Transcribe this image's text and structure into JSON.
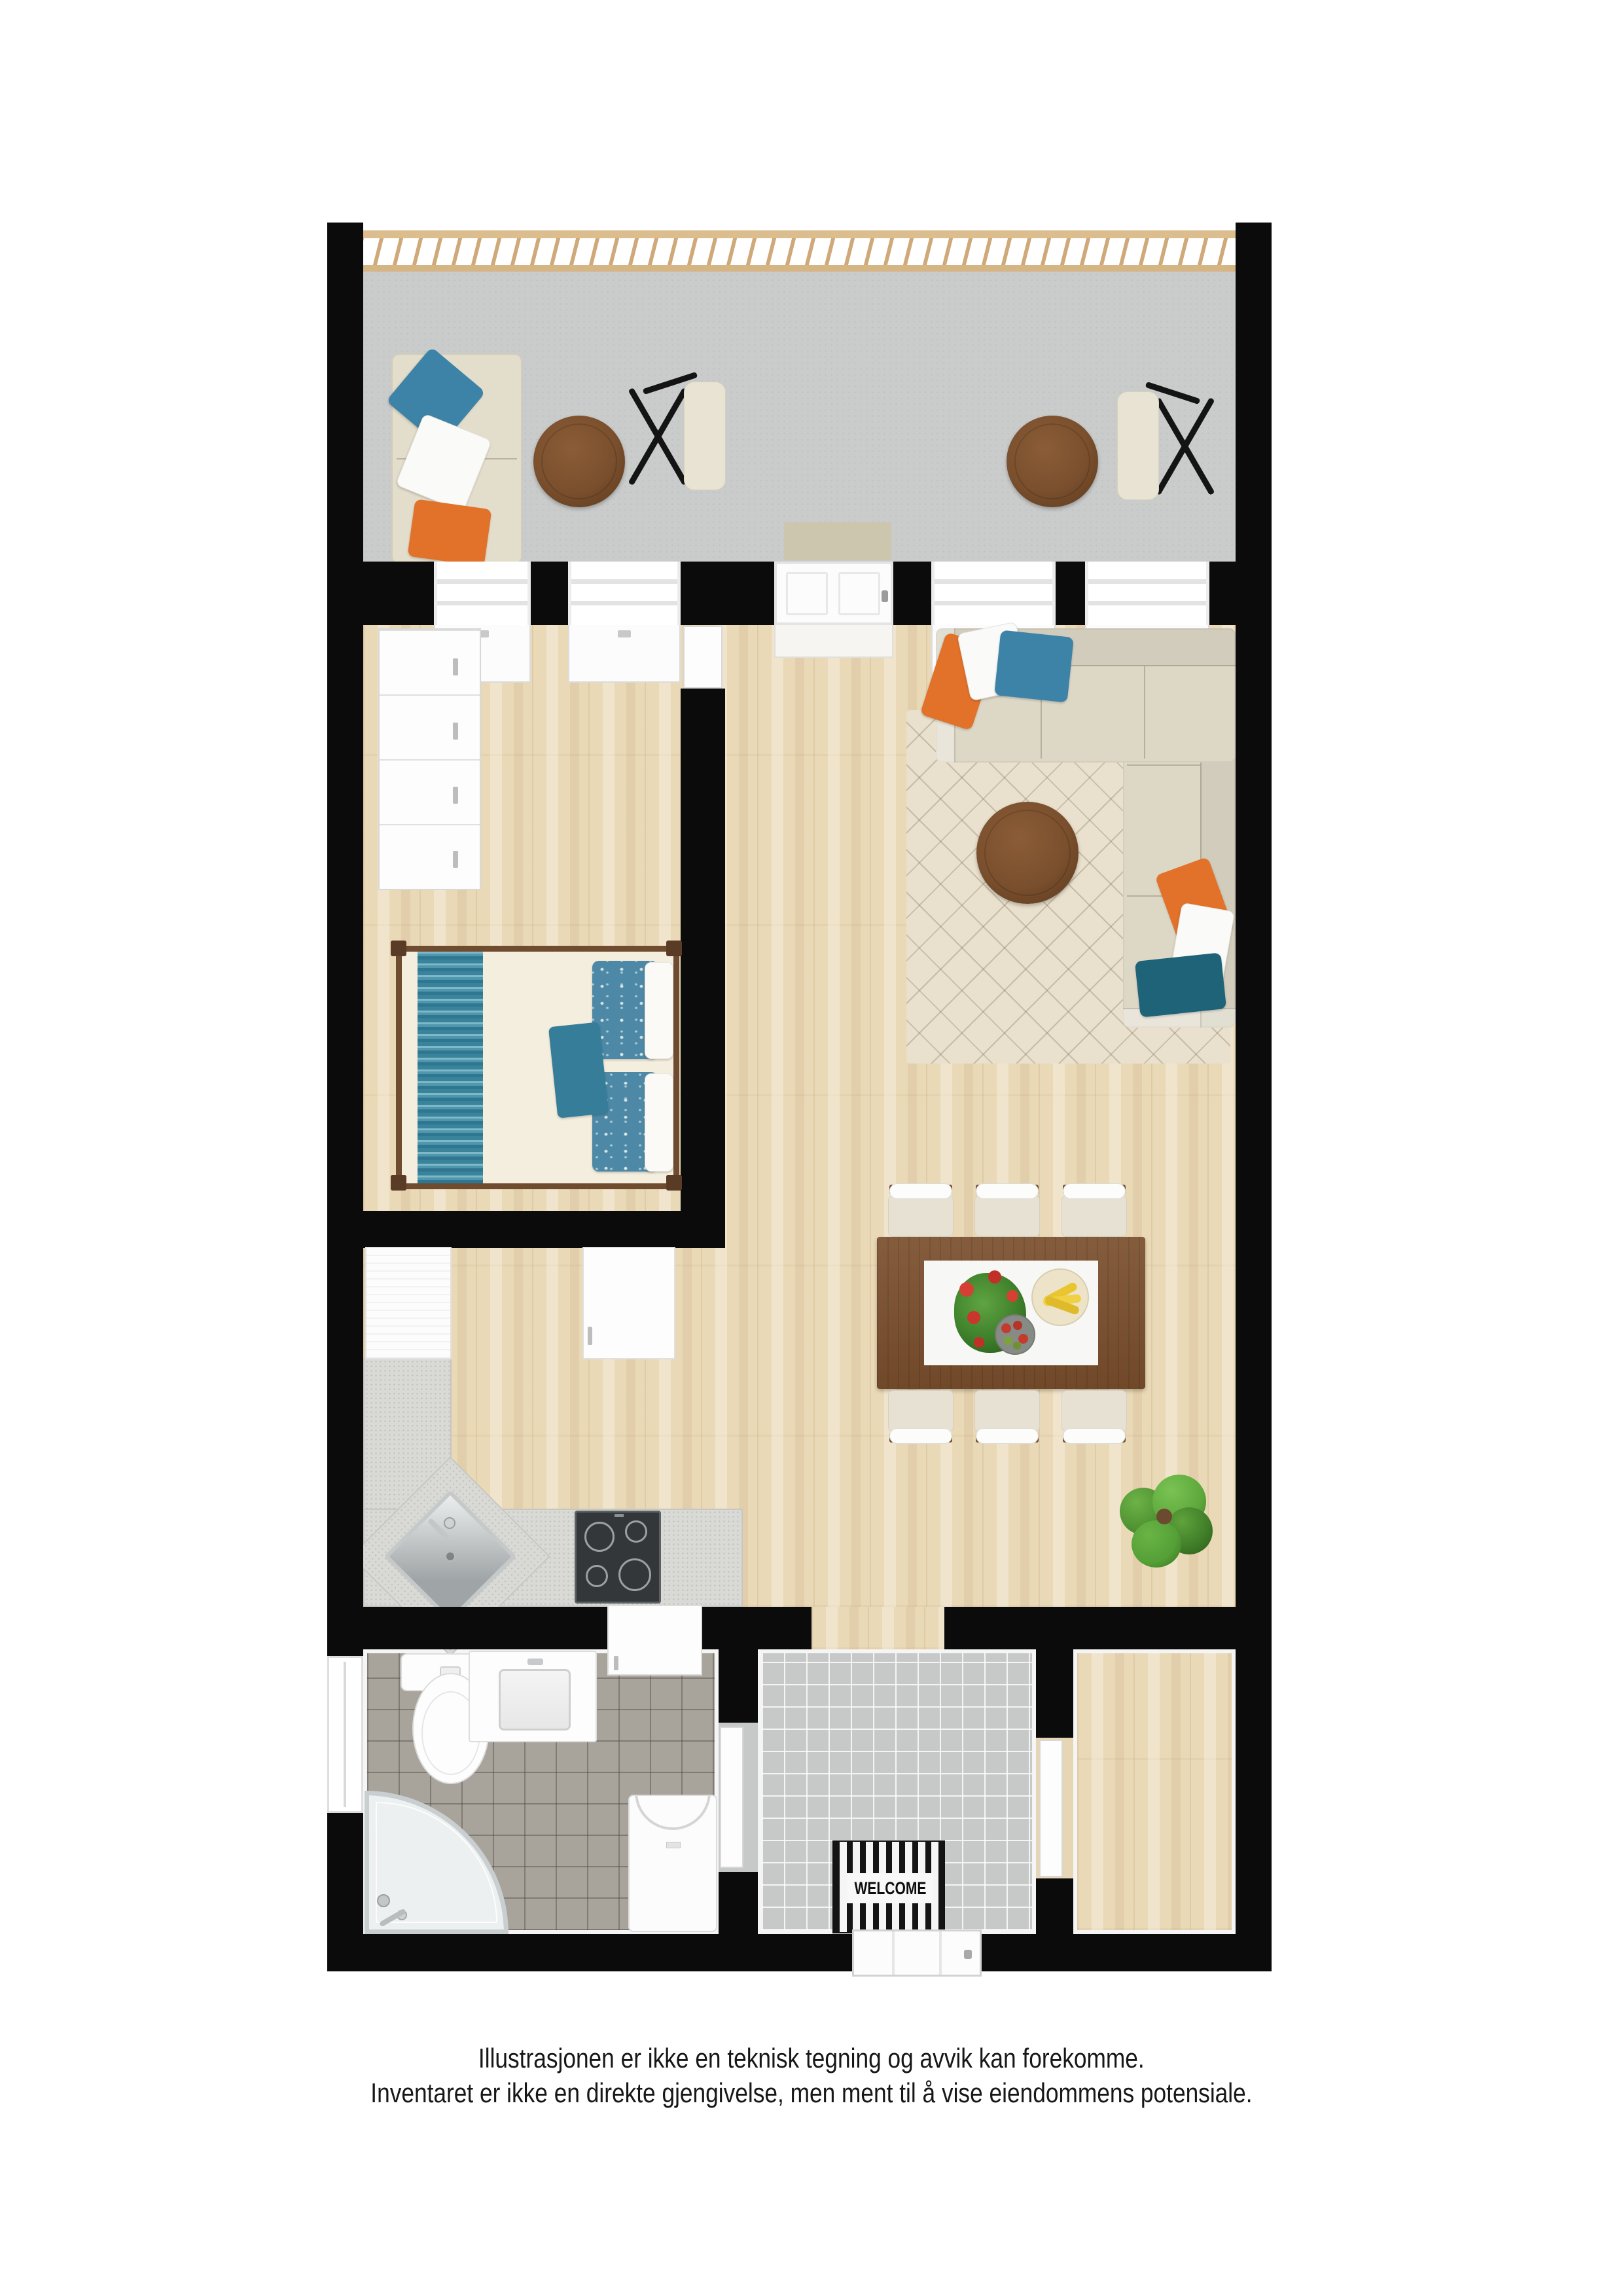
{
  "disclaimer": {
    "line1": "Illustrasjonen er ikke en teknisk tegning og avvik kan forekomme.",
    "line2": "Inventaret er ikke en direkte gjengivelse, men ment til å vise eiendommens potensiale."
  },
  "entry": {
    "welcome_mat_label": "WELCOME"
  },
  "palette": {
    "wall": "#0b0b0b",
    "wood_floor": "#ead9b6",
    "balcony_floor": "#c9cccb",
    "bathroom_tile": "#a8a49b",
    "hall_tile": "#c7c9c8",
    "kitchen_counter": "#d9dad6",
    "sofa": "#ddd7c6",
    "rug": "#e9e0cd",
    "furniture_wood": "#7a4f2d",
    "railing_wood": "#d9b98a",
    "accent_orange": "#e2712a",
    "accent_blue": "#3d83a8",
    "accent_teal": "#1f6379",
    "bed_runner_teal": "#2f7691"
  }
}
